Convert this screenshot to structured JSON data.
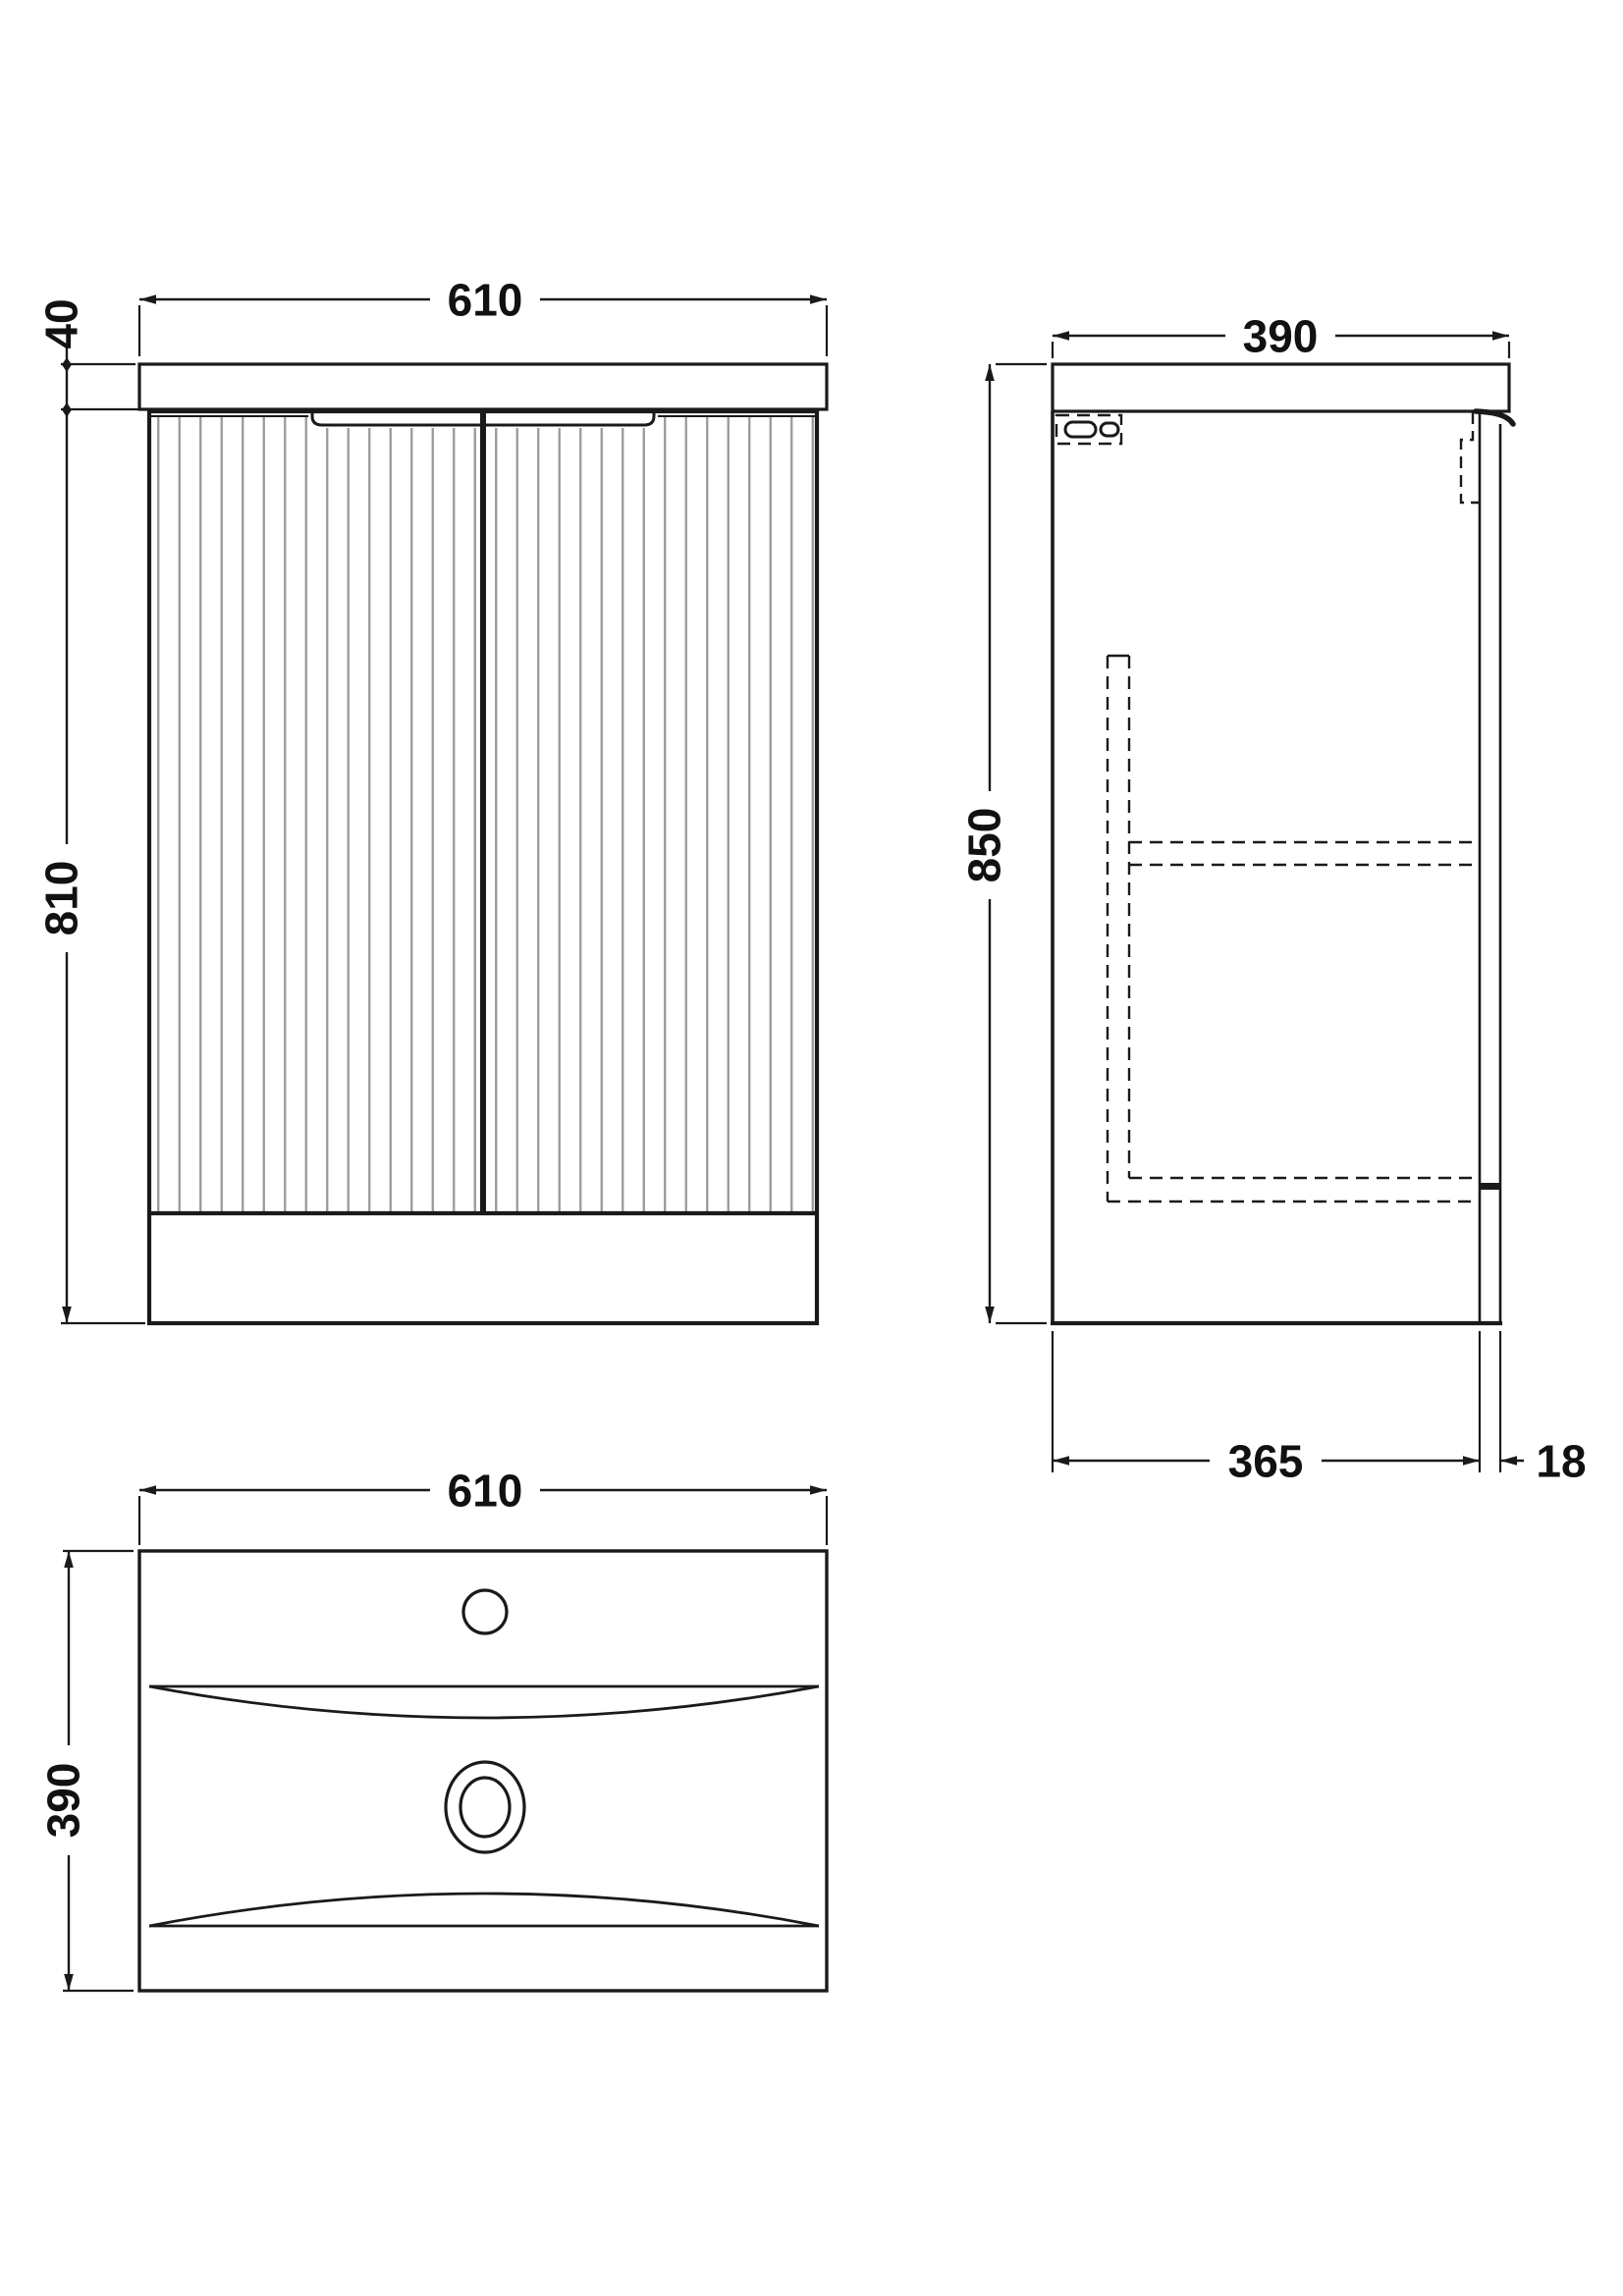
{
  "drawing": {
    "type": "technical-orthographic-drawing",
    "subject": "vanity unit with basin",
    "views": {
      "front": {
        "width_label": "610",
        "worktop_height_label": "40",
        "cabinet_height_label": "810"
      },
      "side": {
        "depth_label": "390",
        "height_label": "850",
        "base_depth_label": "365",
        "panel_thickness_label": "18"
      },
      "plan": {
        "width_label": "610",
        "depth_label": "390"
      }
    },
    "colors": {
      "line": "#1a1a1a",
      "flute": "#999999",
      "background": "#ffffff"
    }
  }
}
